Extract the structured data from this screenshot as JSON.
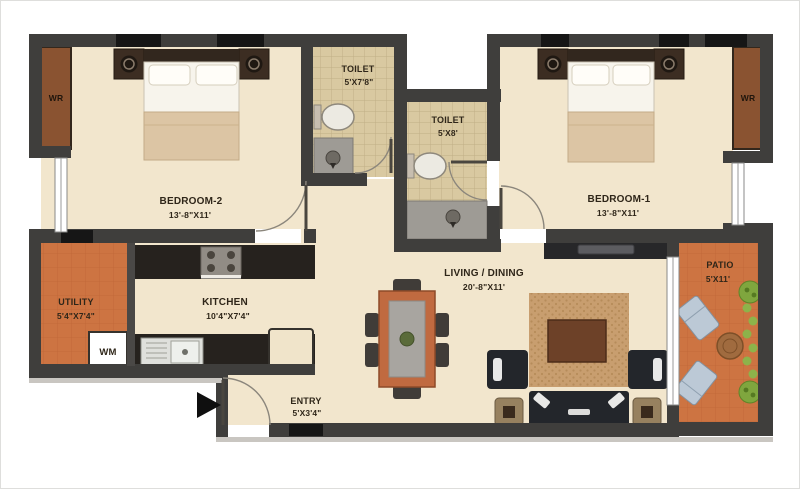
{
  "plan": {
    "rooms": {
      "bedroom2": {
        "name": "BEDROOM-2",
        "dims": "13'-8\"X11'"
      },
      "toilet1": {
        "name": "TOILET",
        "dims": "5'X7'8\""
      },
      "toilet2": {
        "name": "TOILET",
        "dims": "5'X8'"
      },
      "bedroom1": {
        "name": "BEDROOM-1",
        "dims": "13'-8\"X11'"
      },
      "utility": {
        "name": "UTILITY",
        "dims": "5'4\"X7'4\""
      },
      "kitchen": {
        "name": "KITCHEN",
        "dims": "10'4\"X7'4\""
      },
      "living": {
        "name": "LIVING / DINING",
        "dims": "20'-8\"X11'"
      },
      "entry": {
        "name": "ENTRY",
        "dims": "5'X3'4\""
      },
      "patio": {
        "name": "PATIO",
        "dims": "5'X11'"
      }
    },
    "labels": {
      "wardrobe": "WR",
      "washing_machine": "WM"
    },
    "colors": {
      "wall": "#3f3e3c",
      "window_black": "#161616",
      "floor_cream": "#f2e6cd",
      "floor_orange": "#cd7442",
      "floor_tile": "#d9c9a1",
      "shower_gray": "#9e9b95",
      "wardrobe_wood": "#8a5331",
      "counter_dark": "#26221e",
      "rug": "#c89e6f",
      "coffee_table": "#6d4128",
      "sofa_dark": "#23262b",
      "dining_table": "#c06a40",
      "patio_chair": "#bcc9d6",
      "plant_green": "#7fa63e"
    }
  }
}
